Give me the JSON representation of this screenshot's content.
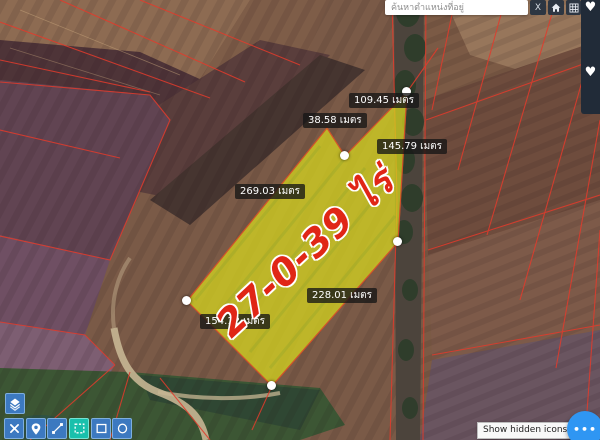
{
  "topbar": {
    "search_placeholder": "ค้นหาตำแหน่งที่อยู่",
    "clear_button": "X",
    "icons": [
      "home-icon",
      "grid-icon"
    ]
  },
  "favorites": {
    "heart_glyph": "♥",
    "icons": [
      "heart-icon",
      "heart-icon"
    ]
  },
  "parcel": {
    "area_label": "27-0-39 ไร่",
    "edge_labels": [
      {
        "text": "109.45 เมตร"
      },
      {
        "text": "38.58 เมตร"
      },
      {
        "text": "145.79 เมตร"
      },
      {
        "text": "269.03 เมตร"
      },
      {
        "text": "228.01 เมตร"
      },
      {
        "text": "154.12 เมตร"
      }
    ],
    "vertex_count": 5
  },
  "toolbar": {
    "layers_button_icon": "layers-icon",
    "tools": [
      "cut",
      "location-pin",
      "measure-distance",
      "draw-polygon",
      "draw-rectangle",
      "draw-circle"
    ],
    "active_tool": "draw-polygon"
  },
  "taskbar": {
    "tooltip": "Show hidden icons",
    "more_button": "•••"
  },
  "colors": {
    "parcel_fill": "#d9da1e",
    "parcel_area_text": "#e02616",
    "boundary_red": "#e23b2c",
    "toolbar_blue": "#3c79c0",
    "toolbar_active": "#19c0ac",
    "topbar_dark": "#2d3642",
    "fab_blue": "#2f96f3"
  }
}
